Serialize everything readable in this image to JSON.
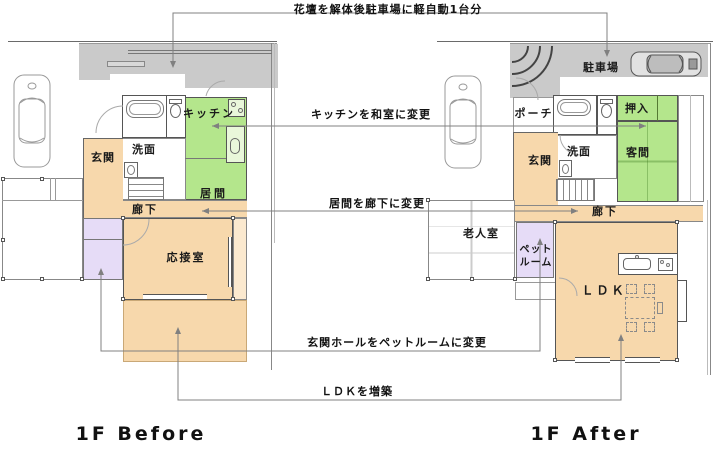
{
  "annotations": {
    "flowerbed": "花壇を解体後駐車場に軽自動1台分",
    "kitchen_change": "キッチンを和室に変更",
    "living_change": "居間を廊下に変更",
    "hall_change": "玄関ホールをペットルームに変更",
    "ldk_extend": "ＬＤＫを増築"
  },
  "before": {
    "title": "1F Before",
    "rooms": {
      "entrance": "玄関",
      "washroom": "洗面",
      "kitchen": "キッチン",
      "living": "居間",
      "corridor": "廊下",
      "reception": "応接室"
    }
  },
  "after": {
    "title": "1F After",
    "rooms": {
      "parking": "駐車場",
      "porch": "ポーチ",
      "entrance": "玄関",
      "washroom": "洗面",
      "closet": "押入",
      "guest": "客間",
      "corridor": "廊下",
      "elderly": "老人室",
      "pet_line1": "ペット",
      "pet_line2": "ルーム",
      "ldk": "ＬＤＫ"
    }
  },
  "colors": {
    "orange": "#f7d8ac",
    "green": "#b4e68c",
    "purple": "#e6dcf7",
    "gray": "#cacaca"
  }
}
